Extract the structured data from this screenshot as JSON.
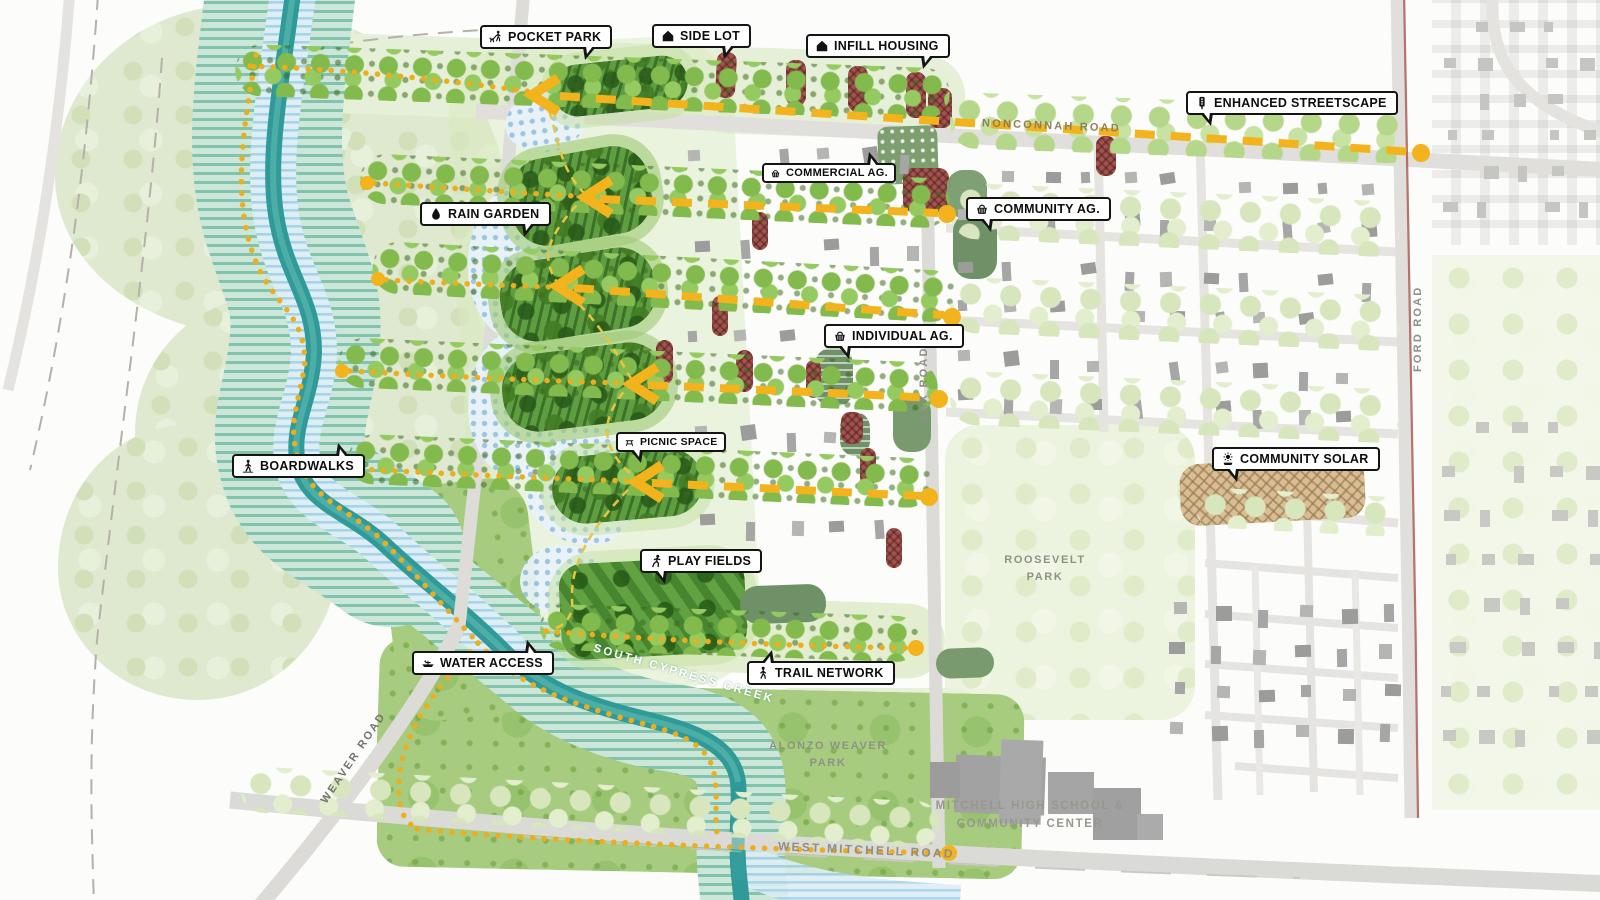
{
  "callouts": [
    {
      "id": "pocket-park",
      "label": "POCKET PARK",
      "icon": "dog-walk-icon"
    },
    {
      "id": "side-lot",
      "label": "SIDE LOT",
      "icon": "house-icon"
    },
    {
      "id": "infill-housing",
      "label": "INFILL HOUSING",
      "icon": "house-icon"
    },
    {
      "id": "enhanced-streetscape",
      "label": "ENHANCED STREETSCAPE",
      "icon": "traffic-light-icon"
    },
    {
      "id": "commercial-ag",
      "label": "COMMERCIAL AG.",
      "icon": "basket-icon"
    },
    {
      "id": "community-ag",
      "label": "COMMUNITY AG.",
      "icon": "basket-icon"
    },
    {
      "id": "rain-garden",
      "label": "RAIN GARDEN",
      "icon": "droplet-icon"
    },
    {
      "id": "individual-ag",
      "label": "INDIVIDUAL AG.",
      "icon": "basket-icon"
    },
    {
      "id": "picnic-space",
      "label": "PICNIC SPACE",
      "icon": "picnic-table-icon"
    },
    {
      "id": "boardwalks",
      "label": "BOARDWALKS",
      "icon": "person-walking-icon"
    },
    {
      "id": "community-solar",
      "label": "COMMUNITY SOLAR",
      "icon": "sun-icon"
    },
    {
      "id": "play-fields",
      "label": "PLAY FIELDS",
      "icon": "person-running-icon"
    },
    {
      "id": "water-access",
      "label": "WATER ACCESS",
      "icon": "boat-icon"
    },
    {
      "id": "trail-network",
      "label": "TRAIL NETWORK",
      "icon": "person-walking-icon"
    }
  ],
  "roads": {
    "nonconnah": "NONCONNAH ROAD",
    "sax": "SAX ROAD",
    "ford": "FORD ROAD",
    "weaver": "WEAVER ROAD",
    "west_mitchell": "WEST MITCHELL ROAD",
    "creek": "SOUTH CYPRESS CREEK"
  },
  "places": {
    "roosevelt": [
      "ROOSEVELT",
      "PARK"
    ],
    "alonzo": [
      "ALONZO WEAVER",
      "PARK"
    ],
    "school": [
      "MITCHELL HIGH SCHOOL &",
      "COMMUNITY CENTER"
    ]
  },
  "colors": {
    "accent_yellow": "#f2b31c",
    "creek_teal": "#339e9c",
    "park_dark_green": "#5f9d41",
    "infill_maroon": "#a1544e",
    "ag_sage_green": "#6f9168",
    "solar_tan": "#d8bd95",
    "label_border": "#141414"
  }
}
